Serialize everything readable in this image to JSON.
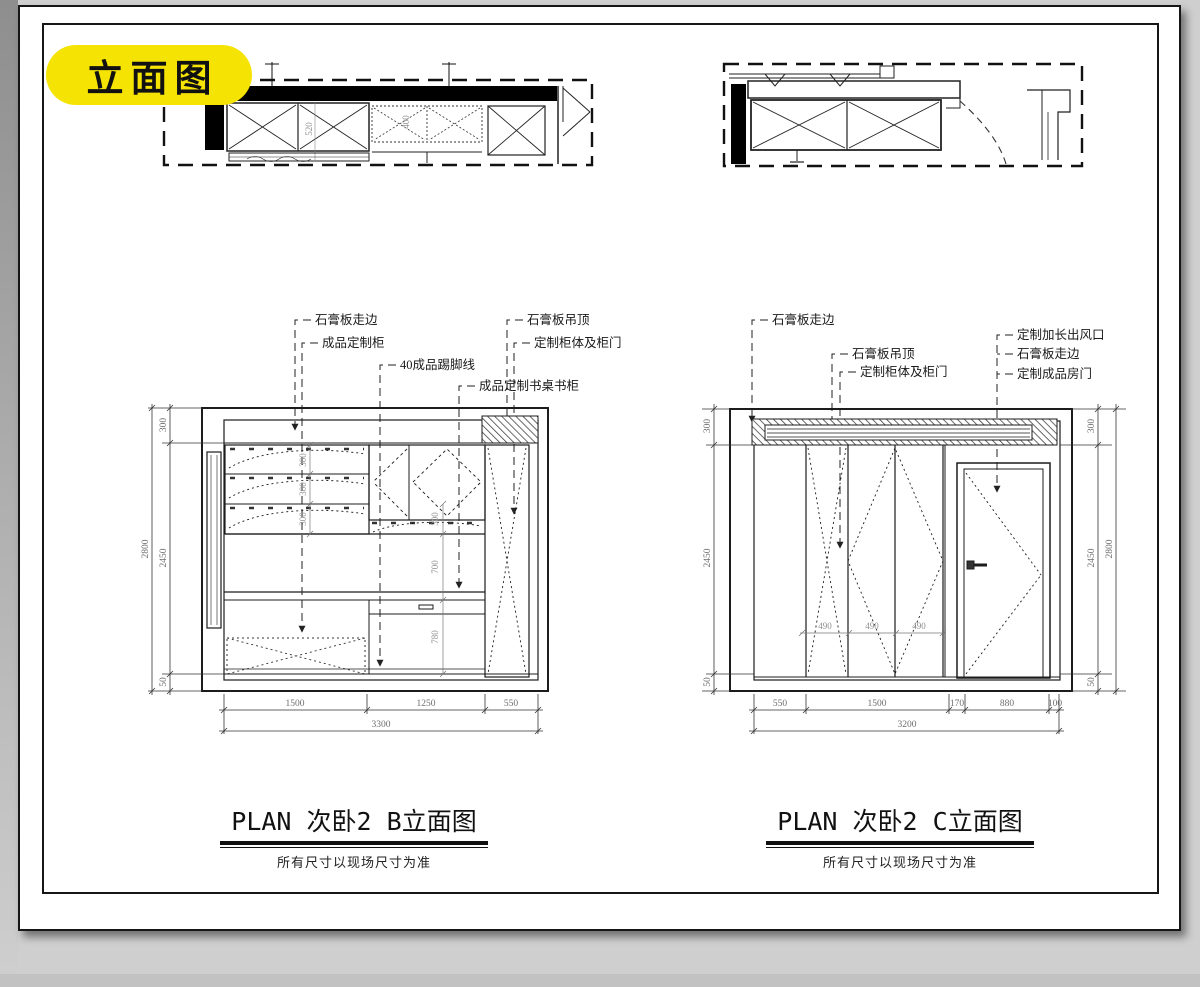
{
  "badge": {
    "label": "立面图",
    "color": "#F5E303"
  },
  "plan_b_strip": {
    "dims": {
      "depth": "520",
      "upper": "400"
    }
  },
  "elevation_b": {
    "title": "PLAN 次卧2 B立面图",
    "note": "所有尺寸以现场尺寸为准",
    "callouts": {
      "c1": "石膏板走边",
      "c2": "成品定制柜",
      "c3": "40成品踢脚线",
      "c4": "石膏板吊顶",
      "c5": "定制柜体及柜门",
      "c6": "成品定制书桌书柜"
    },
    "dims": {
      "bottom": [
        "1500",
        "1250",
        "550"
      ],
      "bottom_total": "3300",
      "side": [
        "300",
        "2450",
        "50"
      ],
      "side_total": "2800",
      "shelf_rows": [
        "300",
        "300",
        "300"
      ],
      "inner_col": [
        "300",
        "700",
        "780"
      ]
    }
  },
  "elevation_c": {
    "title": "PLAN 次卧2 C立面图",
    "note": "所有尺寸以现场尺寸为准",
    "callouts": {
      "c1": "石膏板走边",
      "c2": "石膏板吊顶",
      "c3": "定制柜体及柜门",
      "c4": "定制加长出风口",
      "c5": "石膏板走边",
      "c6": "定制成品房门"
    },
    "dims": {
      "bottom": [
        "550",
        "1500",
        "170",
        "880",
        "100"
      ],
      "bottom_total": "3200",
      "left_side": [
        "300",
        "2450",
        "50"
      ],
      "right_side": [
        "300",
        "2450",
        "50"
      ],
      "right_total": "2800",
      "door_panels": [
        "490",
        "490",
        "490"
      ]
    }
  }
}
